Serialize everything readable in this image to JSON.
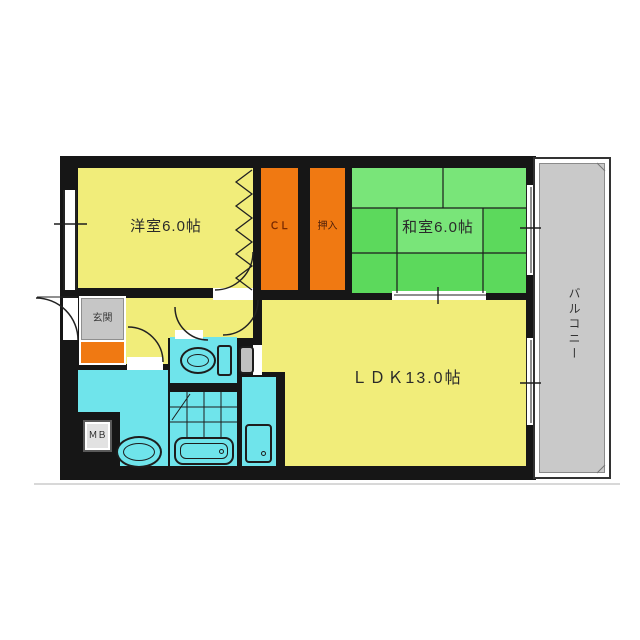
{
  "plan": {
    "rooms": {
      "western": "洋室6.0帖",
      "japanese": "和室6.0帖",
      "ldk": "ＬＤＫ13.0帖",
      "closet": "ＣＬ",
      "oshiire": "押入",
      "entrance": "玄関",
      "balcony": "バルコニー",
      "meter_box": "ＭＢ"
    },
    "colors": {
      "room_yellow": "#F1ED7A",
      "tatami_green": "#5CD95C",
      "tatami_green_light": "#79E579",
      "closet_orange": "#F07912",
      "entrance_floor_orange": "#F07912",
      "wet_area_cyan": "#6FE4EB",
      "balcony_gray": "#C9C9C9",
      "entrance_box_gray": "#C6C6C6",
      "wall_black": "#161616"
    }
  }
}
